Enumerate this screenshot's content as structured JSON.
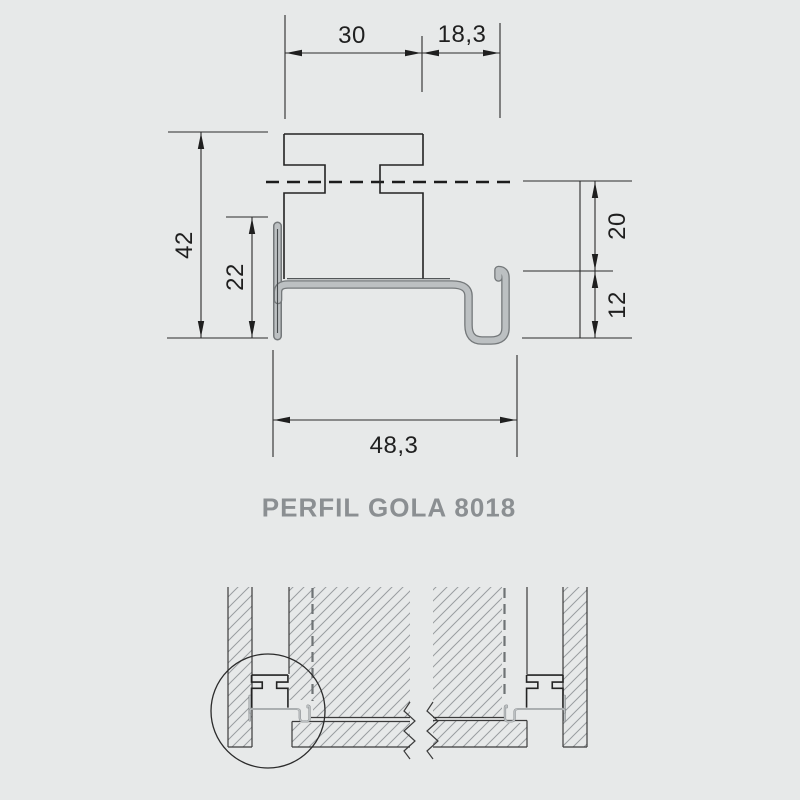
{
  "drawing": {
    "title": "PERFIL GOLA 8018",
    "dimensions": {
      "cap_width": "30",
      "top_right_offset": "18,3",
      "total_height": "42",
      "front_flange_height": "22",
      "upper_step": "20",
      "lower_step": "12",
      "total_width": "48,3"
    },
    "colors": {
      "background": "#e7e9e9",
      "line": "#2b2b2b",
      "profile_fill": "#bcc0c2",
      "profile_edge": "#74787a",
      "hatch": "#999da0",
      "title_text": "#8b8f92",
      "dim_text": "#1f1f1f"
    }
  }
}
